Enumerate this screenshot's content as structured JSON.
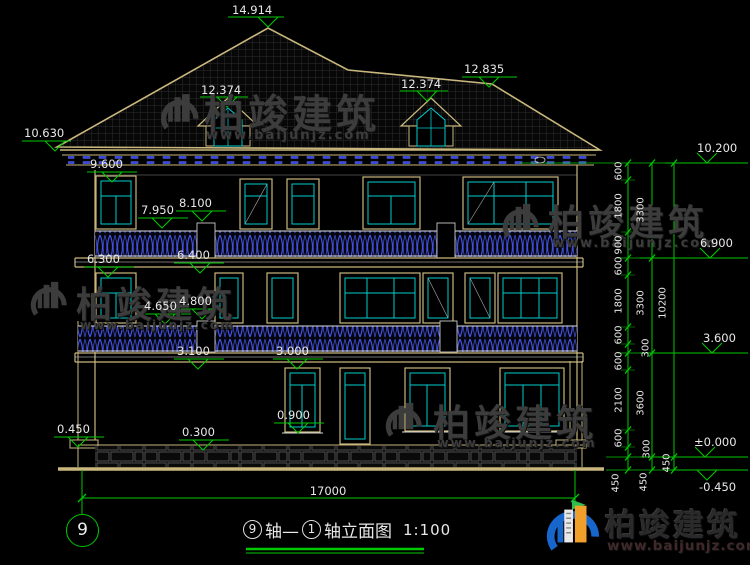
{
  "drawing": {
    "title_axis_start": "9",
    "title_mid": "轴—",
    "title_axis_end": "1",
    "title_suffix": "轴立面图",
    "title_scale": "1:100",
    "axis_bubble": "9"
  },
  "markers": {
    "top": [
      "14.914",
      "12.374",
      "12.374",
      "12.835"
    ],
    "left": [
      "10.630",
      "9.600",
      "7.950",
      "8.100",
      "6.300",
      "6.400",
      "4.650",
      "4.800",
      "3.100",
      "3.000",
      "0.900",
      "0.450",
      "0.300"
    ],
    "right": [
      "10.200",
      "6.900",
      "3.600",
      "±0.000",
      "-0.450"
    ]
  },
  "dimensions": {
    "overall_width": "17000",
    "chain_inner": [
      "600",
      "1800",
      "900",
      "600",
      "1800",
      "600",
      "300",
      "600",
      "2100",
      "600",
      "300",
      "450"
    ],
    "chain_middle": [
      "3300",
      "3300",
      "3600",
      "450"
    ],
    "chain_outer": [
      "10200",
      "450"
    ]
  },
  "watermark": {
    "brand": "柏竣建筑",
    "url": "www.baijunjz.com"
  },
  "colors": {
    "dimension_green": "#00c800",
    "outline_tan": "#c9b77d",
    "window_cyan": "#00cccc",
    "lattice_blue": "#4553e0",
    "text_white": "#e8e8e8"
  }
}
